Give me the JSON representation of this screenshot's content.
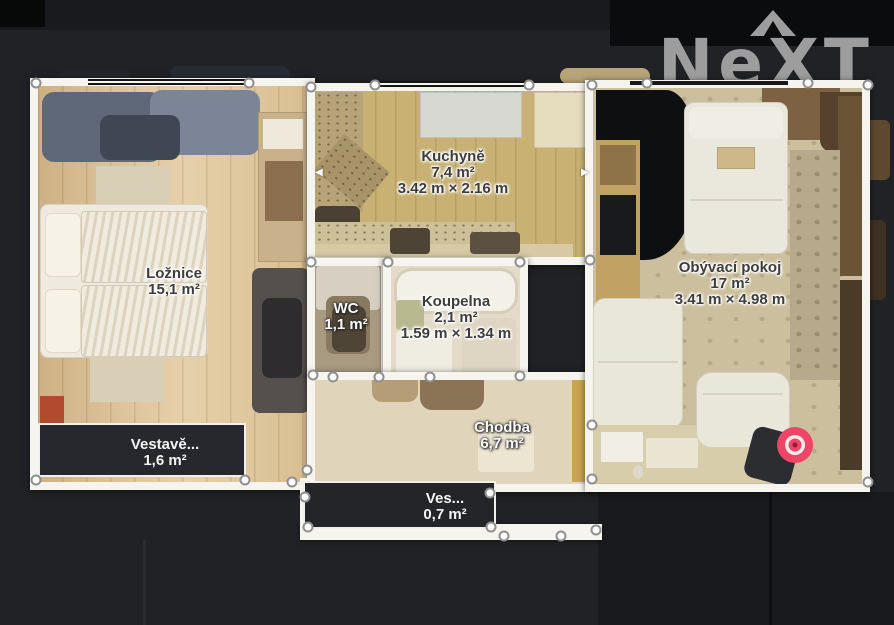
{
  "brand": {
    "logo_text_n": "N",
    "logo_text_e": "e",
    "logo_text_x": "X",
    "logo_text_t": "T",
    "color": "#9d9d9d"
  },
  "floorplan": {
    "rooms": {
      "loznice": {
        "name": "Ložnice",
        "area": "15,1 m²"
      },
      "kuchyne": {
        "name": "Kuchyně",
        "area": "7,4 m²",
        "dimensions": "3.42 m × 2.16 m"
      },
      "wc": {
        "name": "WC",
        "area": "1,1 m²"
      },
      "koupelna": {
        "name": "Koupelna",
        "area": "2,1 m²",
        "dimensions": "1.59 m × 1.34 m"
      },
      "obyvaci_pokoj": {
        "name": "Obývací pokoj",
        "area": "17 m²",
        "dimensions": "3.41 m × 4.98 m"
      },
      "chodba": {
        "name": "Chodba",
        "area": "6,7 m²"
      },
      "vestavena_1": {
        "name": "Vestavě...",
        "area": "1,6 m²"
      },
      "vestavena_2": {
        "name": "Ves...",
        "area": "0,7 m²"
      }
    },
    "marker_color": "#ef4566",
    "marker_center_color": "#8c1f35",
    "wall_color": "#f6f4ef",
    "background_color": "#202225",
    "resize_arrow_left": "◀",
    "resize_arrow_right": "▶"
  }
}
